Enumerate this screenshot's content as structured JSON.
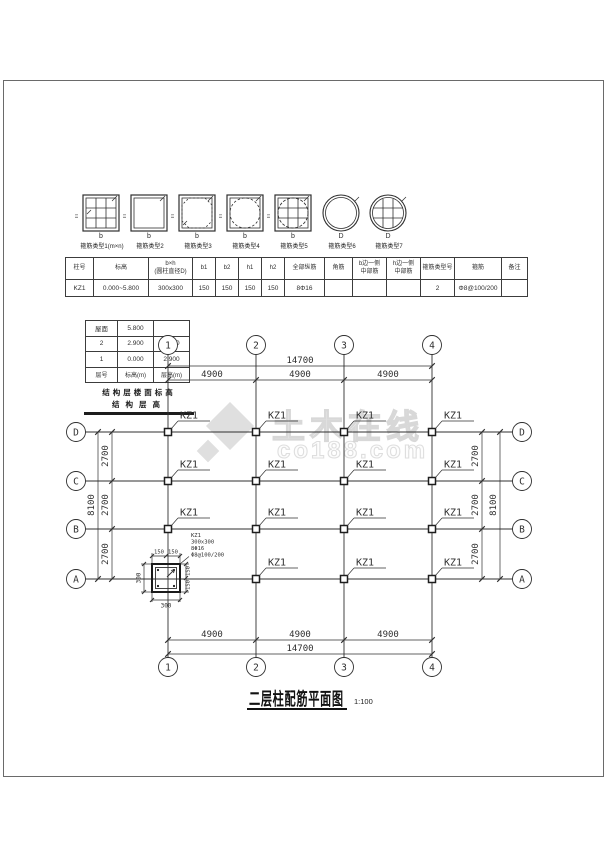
{
  "watermark": {
    "brand": "土木在线",
    "site": "co188.com",
    "color": "#c9c9c9"
  },
  "stirrup_types": [
    {
      "label": "箍筋类型1(m×n)",
      "side": "h",
      "base": "b"
    },
    {
      "label": "箍筋类型2",
      "side": "h",
      "base": "b"
    },
    {
      "label": "箍筋类型3",
      "side": "h",
      "base": "b"
    },
    {
      "label": "箍筋类型4",
      "side": "h",
      "base": "b"
    },
    {
      "label": "箍筋类型5",
      "side": "h",
      "base": "b"
    },
    {
      "label": "箍筋类型6",
      "base": "D"
    },
    {
      "label": "箍筋类型7",
      "base": "D"
    }
  ],
  "column_table": {
    "headers": [
      "柱号",
      "标高",
      "b×h\n(圆柱直径D)",
      "b1",
      "b2",
      "h1",
      "h2",
      "全部纵筋",
      "角筋",
      "b边一侧\n中部筋",
      "h边一侧\n中部筋",
      "箍筋类型号",
      "箍筋",
      "备注"
    ],
    "row": [
      "KZ1",
      "0.000~5.800",
      "300x300",
      "150",
      "150",
      "150",
      "150",
      "8Φ16",
      "",
      "",
      "",
      "2",
      "Φ8@100/200",
      ""
    ]
  },
  "level_table": {
    "rows": [
      [
        "屋面",
        "5.800",
        ""
      ],
      [
        "2",
        "2.900",
        "2.900"
      ],
      [
        "1",
        "0.000",
        "2.900"
      ]
    ],
    "footer": [
      "层号",
      "标高(m)",
      "层高(m)"
    ],
    "caption1": "结构层楼面标高",
    "caption2": "结构层高"
  },
  "plan": {
    "grid_cols": [
      "1",
      "2",
      "3",
      "4"
    ],
    "grid_rows": [
      "D",
      "C",
      "B",
      "A"
    ],
    "dim_total_h": "14700",
    "dim_seg_h": [
      "4900",
      "4900",
      "4900"
    ],
    "dim_total_v": "8100",
    "dim_seg_v": [
      "2700",
      "2700",
      "2700"
    ],
    "column_label": "KZ1",
    "detail": {
      "name": "KZ1",
      "size": "300x300",
      "rebar": "8Φ16",
      "stirrup": "Φ8@100/200",
      "dim_w": "300",
      "dim_h": "300",
      "dim_half": "150"
    }
  },
  "title_block": {
    "title": "二层柱配筋平面图",
    "scale": "1:100"
  }
}
